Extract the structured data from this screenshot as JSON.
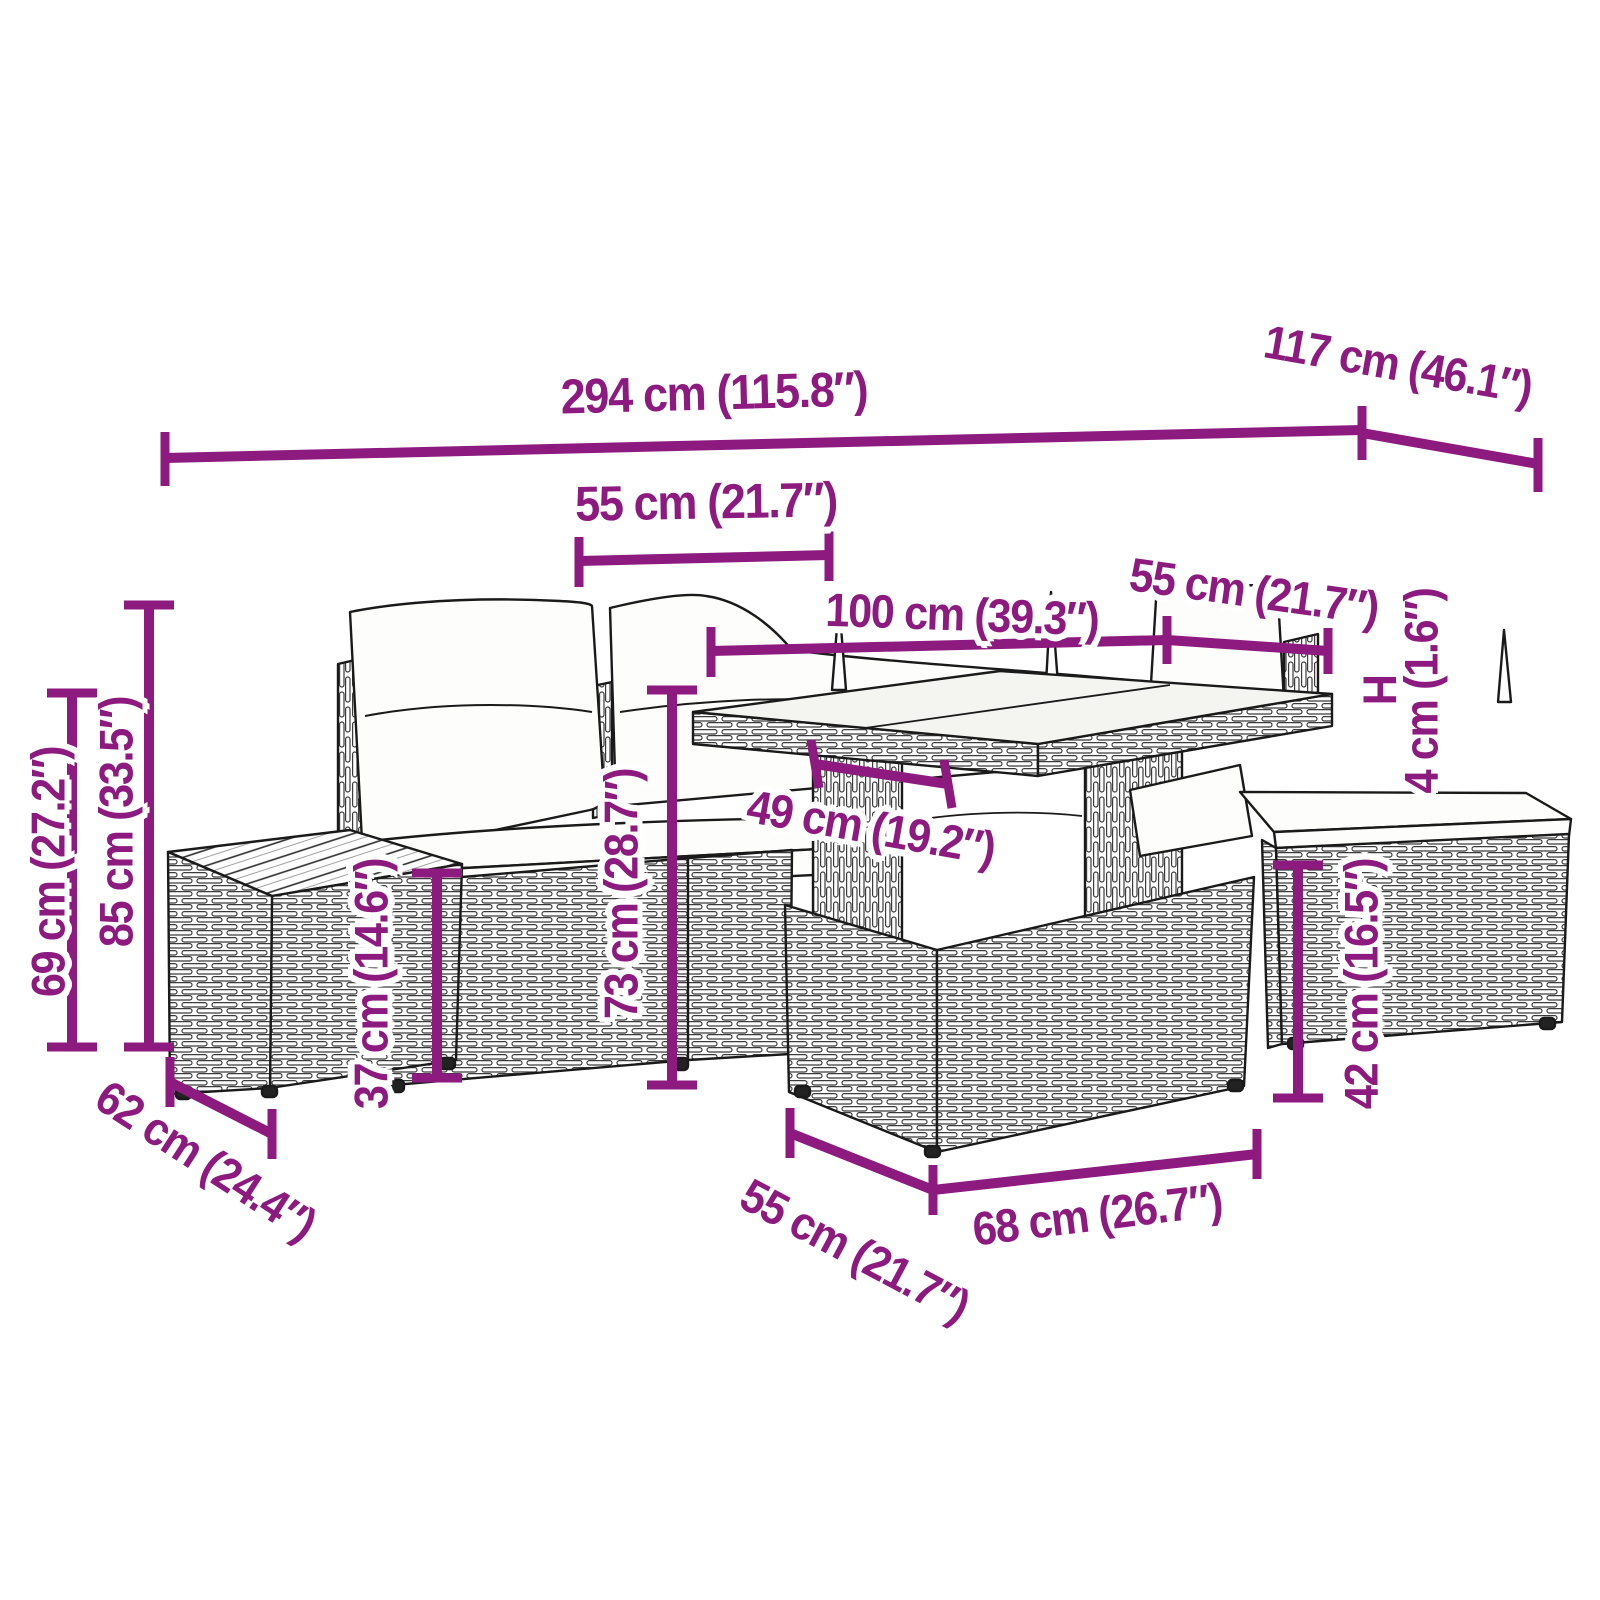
{
  "diagram": {
    "type": "product-dimension-diagram",
    "subject": "rattan garden furniture set (corner sofa, glass-top table, ottomans) line drawing",
    "accent_color": "#8d1a7f",
    "line_art_color": "#1a1a1a"
  },
  "labels": [
    {
      "id": "dim-294",
      "text": "294 cm (115.8″)"
    },
    {
      "id": "dim-117",
      "text": "117 cm (46.1″)"
    },
    {
      "id": "dim-55-top",
      "text": "55 cm (21.7″)"
    },
    {
      "id": "dim-100",
      "text": "100 cm (39.3″)"
    },
    {
      "id": "dim-55-right",
      "text": "55 cm (21.7″)"
    },
    {
      "id": "dim-H",
      "text": "H"
    },
    {
      "id": "dim-4",
      "text": "4 cm (1.6″)"
    },
    {
      "id": "dim-85",
      "text": "85 cm (33.5″)"
    },
    {
      "id": "dim-69",
      "text": "69 cm (27.2″)"
    },
    {
      "id": "dim-37",
      "text": "37 cm (14.6″)"
    },
    {
      "id": "dim-73",
      "text": "73 cm (28.7″)"
    },
    {
      "id": "dim-49",
      "text": "49 cm (19.2″)"
    },
    {
      "id": "dim-42",
      "text": "42 cm (16.5″)"
    },
    {
      "id": "dim-62",
      "text": "62 cm (24.4″)"
    },
    {
      "id": "dim-55-bottom",
      "text": "55 cm (21.7″)"
    },
    {
      "id": "dim-68",
      "text": "68 cm (26.7″)"
    }
  ]
}
